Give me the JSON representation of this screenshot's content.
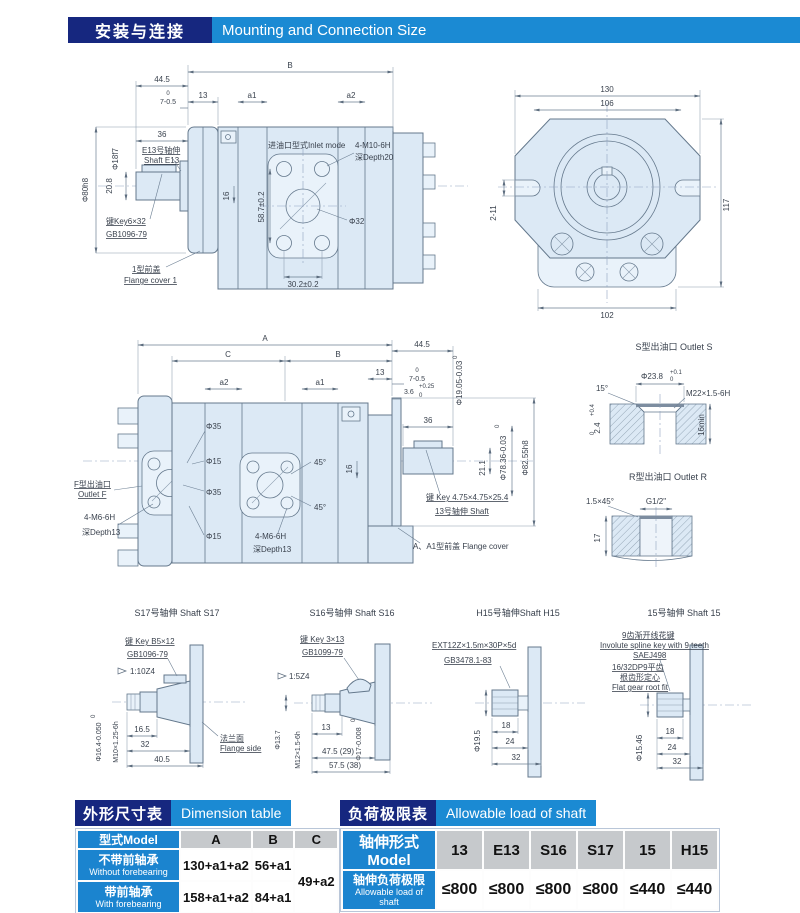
{
  "header": {
    "title_zh": "安装与连接",
    "title_en": "Mounting and Connection Size"
  },
  "top_side": {
    "dims": {
      "w445": "44.5",
      "B": "B",
      "w13": "13",
      "a1": "a1",
      "a2": "a2",
      "zero": "0",
      "w7": "7-0.5",
      "w36": "36",
      "phi18": "Φ18f7",
      "phi80": "Φ80h8",
      "h208": "20.8",
      "h16": "16",
      "h587": "58.7±0.2",
      "phi32": "Φ32",
      "w302": "30.2±0.2"
    },
    "labels": {
      "inlet": "进油口型式Inlet mode",
      "m10": "4-M10-6H",
      "depth20": "深Depth20",
      "shaft_zh": "E13号轴伸",
      "shaft_en": "Shaft E13",
      "key": "键Key6×32",
      "gb": "GB1096-79",
      "cover_zh": "1型前盖",
      "cover_en": "Flange cover 1"
    }
  },
  "front": {
    "dims": {
      "w130": "130",
      "w106": "106",
      "h117": "117",
      "w102": "102",
      "s211": "2-11"
    }
  },
  "mid_side": {
    "dims": {
      "A": "A",
      "C": "C",
      "B": "B",
      "w445": "44.5",
      "w13": "13",
      "zero": "0",
      "w7": "7-0.5",
      "tol025": "+0.25",
      "w36": "3.6",
      "phi1905": "Φ19.05-0.03",
      "a2": "a2",
      "a1": "a1",
      "w36s": "36",
      "phi35a": "Φ35",
      "phi15a": "Φ15",
      "phi35b": "Φ35",
      "phi15b": "Φ15",
      "a45a": "45°",
      "a45b": "45°",
      "h16": "16",
      "h211": "21.1",
      "phi7836": "Φ78.36-0.03",
      "phi8255": "Φ82.55h8"
    },
    "labels": {
      "key": "键 Key 4.75×4.75×25.4",
      "shaft": "13号轴伸 Shaft",
      "outlet_zh": "F型出油口",
      "outlet_en": "Outlet F",
      "m6l": "4-M6-6H",
      "depth13l": "深Depth13",
      "m6m": "4-M6-6H",
      "depth13m": "深Depth13",
      "cover": "A、A1型前盖 Flange cover"
    }
  },
  "outlet_s": {
    "title": "S型出油口 Outlet S",
    "phi238": "Φ23.8",
    "tol_top": "+0.1",
    "tol_bot": "0",
    "a15": "15°",
    "m22": "M22×1.5-6H",
    "h24": "2.4",
    "h24t": "+0.4",
    "h24b": "0",
    "min16": "16min"
  },
  "outlet_r": {
    "title": "R型出油口 Outlet R",
    "ch": "1.5×45°",
    "g12": "G1/2\"",
    "h17": "17"
  },
  "s17": {
    "title": "S17号轴伸 Shaft S17",
    "key": "键 Key B5×12",
    "gb": "GB1096-79",
    "taper": "1:10Z4",
    "l165": "16.5",
    "l32": "32",
    "l405": "40.5",
    "phi": "Φ16.4-0.050",
    "zero": "0",
    "thread": "M10×1.25-6h",
    "flange_zh": "法兰面",
    "flange_en": "Flange side"
  },
  "s16": {
    "title": "S16号轴伸 Shaft S16",
    "key": "键 Key 3×13",
    "gb": "GB1099-79",
    "taper": "1:5Z4",
    "l13": "13",
    "l475": "47.5 (29)",
    "l575": "57.5 (38)",
    "phi17": "Φ17-0.008",
    "zero": "0",
    "thread": "M12×1.5-6h",
    "phi137": "Φ13.7"
  },
  "h15": {
    "title": "H15号轴伸Shaft H15",
    "spline": "EXT12Z×1.5m×30P×5d",
    "gb": "GB3478.1-83",
    "phi": "Φ19.5",
    "l18": "18",
    "l24": "24",
    "l32": "32"
  },
  "sh15": {
    "title": "15号轴伸 Shaft 15",
    "sp_zh": "9齿渐开线花键",
    "sp_en": "Involute spline key with 9 teeth",
    "sae": "SAEJ498",
    "fit1": "16/32DP9平齿",
    "fit2": "根齿形定心",
    "fit3": "Flat gear root fit",
    "phi": "Φ15.46",
    "l18": "18",
    "l24": "24",
    "l32": "32"
  },
  "dim_table": {
    "title_zh": "外形尺寸表",
    "title_en": "Dimension table",
    "model": "型式Model",
    "colA": "A",
    "colB": "B",
    "colC": "C",
    "rows": [
      {
        "zh": "不带前轴承",
        "en": "Without forebearing",
        "A": "130+a1+a2",
        "B": "56+a1"
      },
      {
        "zh": "带前轴承",
        "en": "With forebearing",
        "A": "158+a1+a2",
        "B": "84+a1"
      }
    ],
    "C_val": "49+a2"
  },
  "load_table": {
    "title_zh": "负荷极限表",
    "title_en": "Allowable load of shaft",
    "model": "轴伸形式Model",
    "models": [
      "13",
      "E13",
      "S16",
      "S17",
      "15",
      "H15"
    ],
    "row_zh": "轴伸负荷极限",
    "row_en": "Allowable load of shaft",
    "loads": [
      "≤800",
      "≤800",
      "≤800",
      "≤800",
      "≤440",
      "≤440"
    ]
  }
}
